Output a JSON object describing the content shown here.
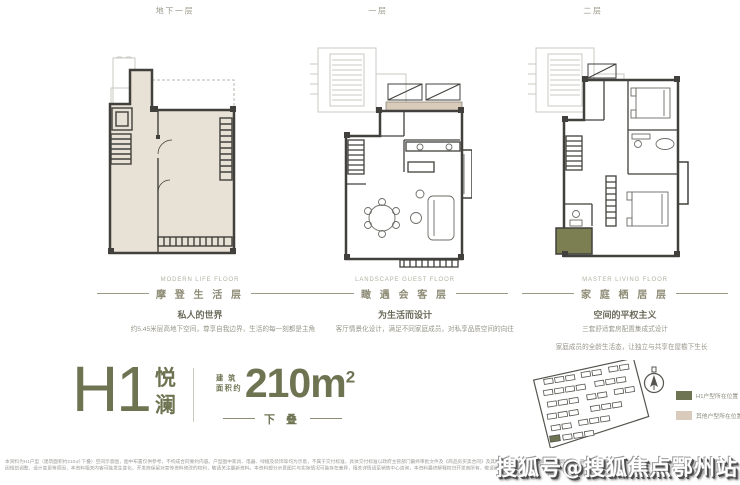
{
  "colors": {
    "accent_olive": "#6e7452",
    "plan_beige": "#e8e1d5",
    "terrace_green": "#7b7f52",
    "wall_dark": "#41403c"
  },
  "floors": [
    {
      "title": "地下一层",
      "section": {
        "en": "MODERN LIFE FLOOR",
        "cn": "摩 登 生 活 层",
        "subtitle": "私人的世界",
        "body1": "约5.45米层高地下空间，尊享自我边界，生活的每一刻都是主角"
      }
    },
    {
      "title": "一层",
      "section": {
        "en": "LANDSCAPE GUEST FLOOR",
        "cn": "瞰 遇 会 客 层",
        "subtitle": "为生活而设计",
        "body1": "客厅情景化设计，满足不同家庭成员，对私享品质空间的向往"
      }
    },
    {
      "title": "二层",
      "section": {
        "en": "MASTER LIVING FLOOR",
        "cn": "家 庭 栖 居 层",
        "subtitle": "空间的平权主义",
        "body1": "三套舒适套房配置集成式设计",
        "body2": "家庭成员的全龄生活态，让独立与共享在屋檐下生长"
      }
    }
  ],
  "unit": {
    "model": "H1",
    "name_char1": "悦",
    "name_char2": "澜",
    "area_prefix_top": "建 筑",
    "area_prefix_bottom": "面积约",
    "area_value": "210m",
    "area_sup": "2",
    "tier": "下 叠"
  },
  "legend": [
    {
      "label": "H1户型所在位置",
      "color": "#6e7452"
    },
    {
      "label": "其他户型所在位置",
      "color": "#d9cbbb"
    }
  ],
  "disclaimer": {
    "line1": "本资料为H1户型（建筑面积约210㎡·下叠）空间示意图，图中布置仅供参考，不构成合同要约内容。户型图中家具、电器、绿植及装饰等均为示意，不属于交付标准，具体交付标准以政府主管部门最终审批文件及《商品房买卖合同》及其附件约定为准，所示面积均为建筑面积，最终以实测面积为准。",
    "line2": "因规划调整、设计变更等原因，本资料相关内容可能发生变化，开发商保留对宣传资料修改的权利，敬请关注最新资料。本资料部分示意图片与实际情况可能存在差异，相关详情请至销售中心咨询，本资料最终解释权归开发商所有，敬请留意。"
  },
  "watermark": {
    "text": "搜狐号@搜狐焦点鄂州站"
  }
}
